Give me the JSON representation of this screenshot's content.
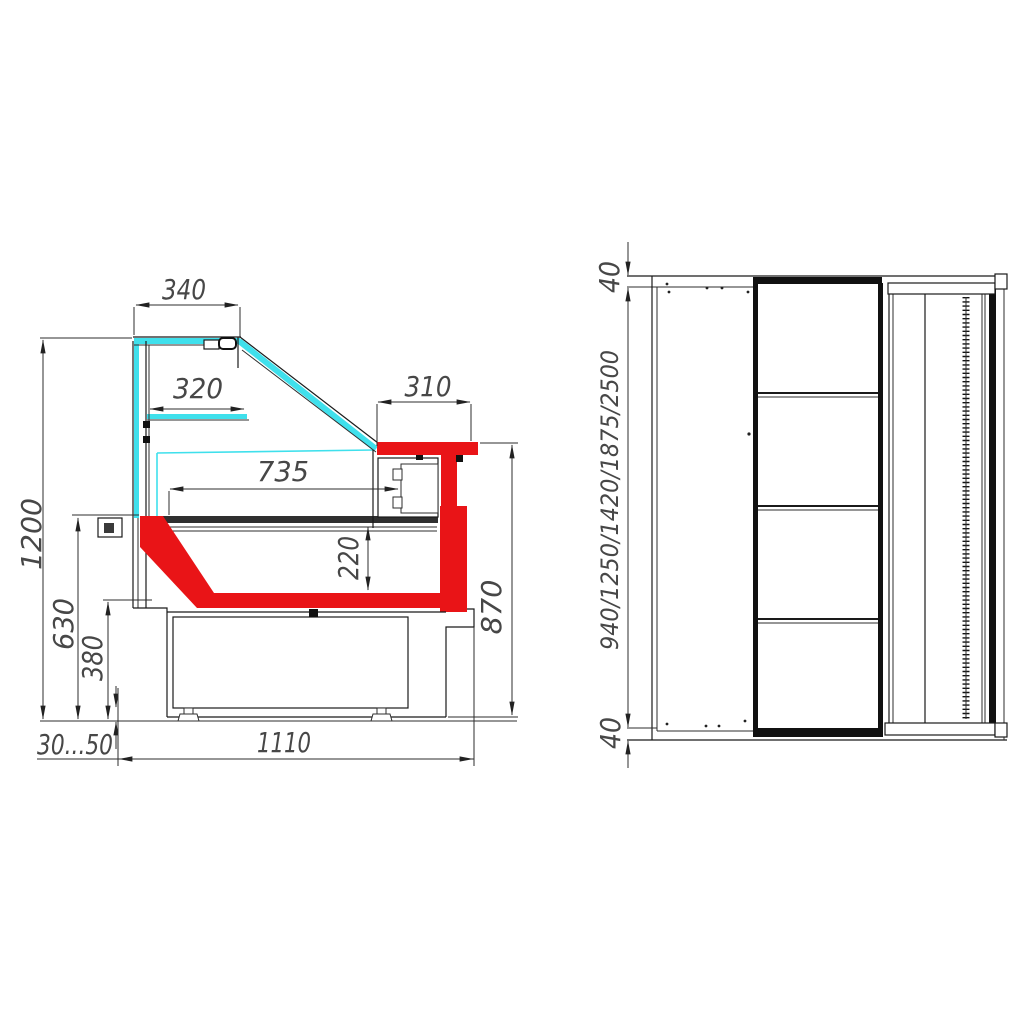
{
  "drawing": {
    "kind": "refrigerated display counter dimensional drawing",
    "side_view": {
      "dims": {
        "d340": "340",
        "d320": "320",
        "d310": "310",
        "d735": "735",
        "d220": "220",
        "d1200": "1200",
        "d630": "630",
        "d380": "380",
        "d30_50": "30...50",
        "d1110": "1110",
        "d870": "870"
      }
    },
    "front_view": {
      "dims": {
        "top40": "40",
        "lengths": "940/1250/1420/1875/2500",
        "bottom40": "40"
      }
    },
    "colors": {
      "glass_accent": "#3fe0ec",
      "profile_highlight": "#e91417",
      "linework": "#1a1a1a",
      "dimension_text": "#474747",
      "background": "#ffffff"
    }
  }
}
